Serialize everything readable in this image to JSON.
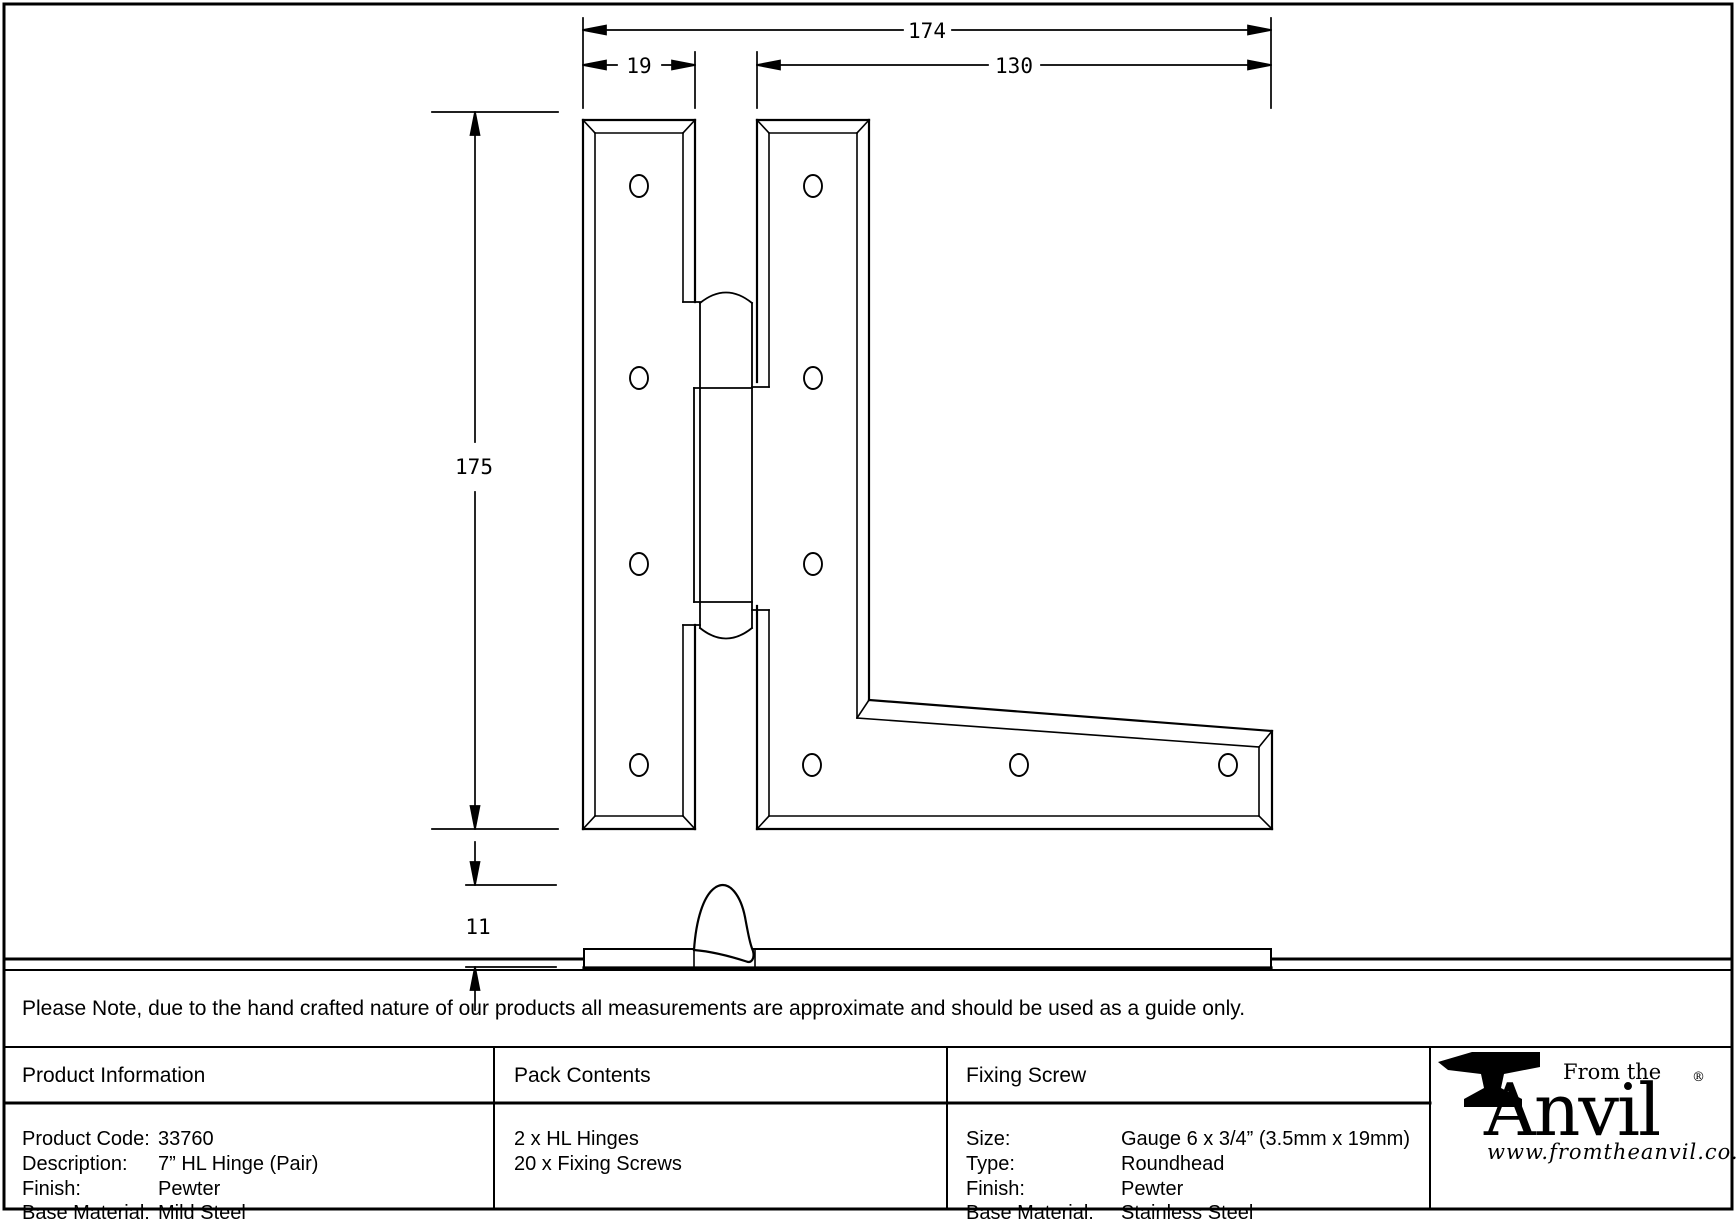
{
  "drawing": {
    "dimensions": {
      "overall_width": "174",
      "left_plate_width": "19",
      "right_plate_width": "130",
      "height": "175",
      "side_profile_height": "11"
    }
  },
  "note": {
    "text": "Please Note, due to the hand crafted nature of our products all measurements are approximate and should be used as a guide only."
  },
  "table": {
    "product_information": {
      "header": "Product Information",
      "rows": [
        {
          "label": "Product Code:",
          "value": "33760"
        },
        {
          "label": "Description:",
          "value": "7” HL Hinge (Pair)"
        },
        {
          "label": "Finish:",
          "value": "Pewter"
        },
        {
          "label": "Base Material:",
          "value": "Mild Steel"
        }
      ]
    },
    "pack_contents": {
      "header": "Pack Contents",
      "items": [
        "2 x HL Hinges",
        "20 x Fixing Screws"
      ]
    },
    "fixing_screw": {
      "header": "Fixing Screw",
      "rows": [
        {
          "label": "Size:",
          "value": "Gauge 6 x 3/4” (3.5mm x 19mm)"
        },
        {
          "label": "Type:",
          "value": "Roundhead"
        },
        {
          "label": "Finish:",
          "value": "Pewter"
        },
        {
          "label": "Base Material:",
          "value": "Stainless Steel"
        }
      ]
    },
    "brand": {
      "tagline": "From the",
      "name": "Anvil",
      "registered_mark": "®",
      "website": "www.fromtheanvil.co.uk"
    }
  },
  "colors": {
    "line": "#000000",
    "background": "#ffffff"
  }
}
